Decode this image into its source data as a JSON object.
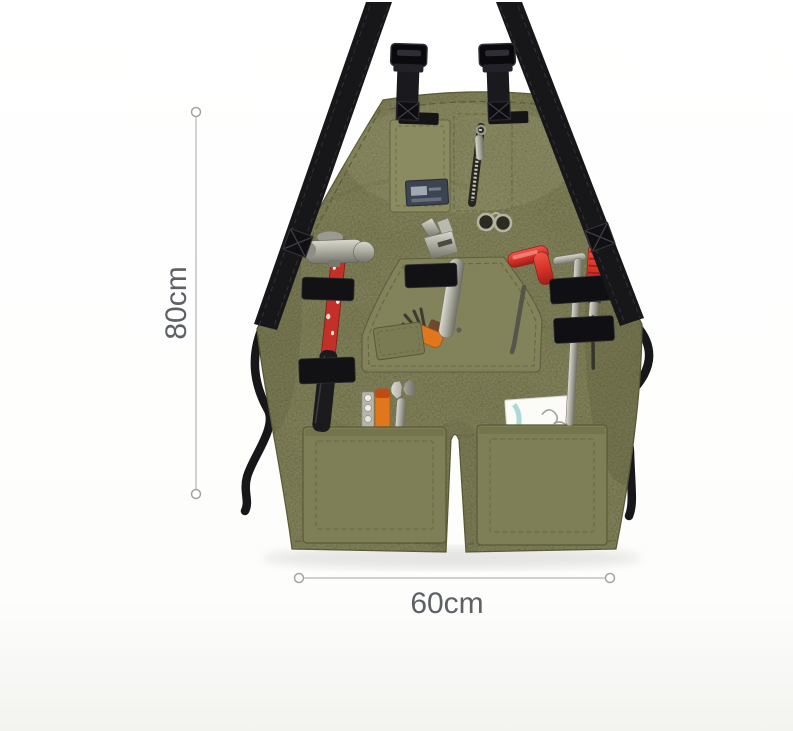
{
  "page": {
    "background_top": "#ffffff",
    "background_bottom": "#f3f3f0"
  },
  "dimension_annotations": {
    "vertical": {
      "label": "80cm"
    },
    "horizontal": {
      "label": "60cm"
    },
    "line_color": "#b6b6b4",
    "marker_fill": "#ffffff",
    "marker_stroke": "#a4a4a2",
    "label_color": "#5d6065"
  },
  "product": {
    "name": "canvas-tool-apron",
    "fabric_color": "#81815a",
    "fabric_shadow": "#6d6d48",
    "fabric_light": "#9b9b71",
    "pocket_color": "#7e7e57",
    "strap_color": "#17171a",
    "hardware_color": "#9da08f",
    "accent_red": "#d23228",
    "accent_orange": "#e0771d",
    "label_patch_color": "#3b4450",
    "features": [
      "shoulder-straps",
      "plastic-buckles",
      "chest-pocket",
      "zip-pocket",
      "brand-label",
      "folded-glasses",
      "center-pouch",
      "elastic-tool-loops",
      "two-bottom-pockets",
      "waist-ties"
    ],
    "tools_displayed": [
      "claw-hammer",
      "adjustable-wrench",
      "hex-screwdriver",
      "allen-key",
      "bit-driver",
      "folding-hex-key-set",
      "open-end-spanner",
      "bit-holder-tool",
      "note-card"
    ]
  }
}
